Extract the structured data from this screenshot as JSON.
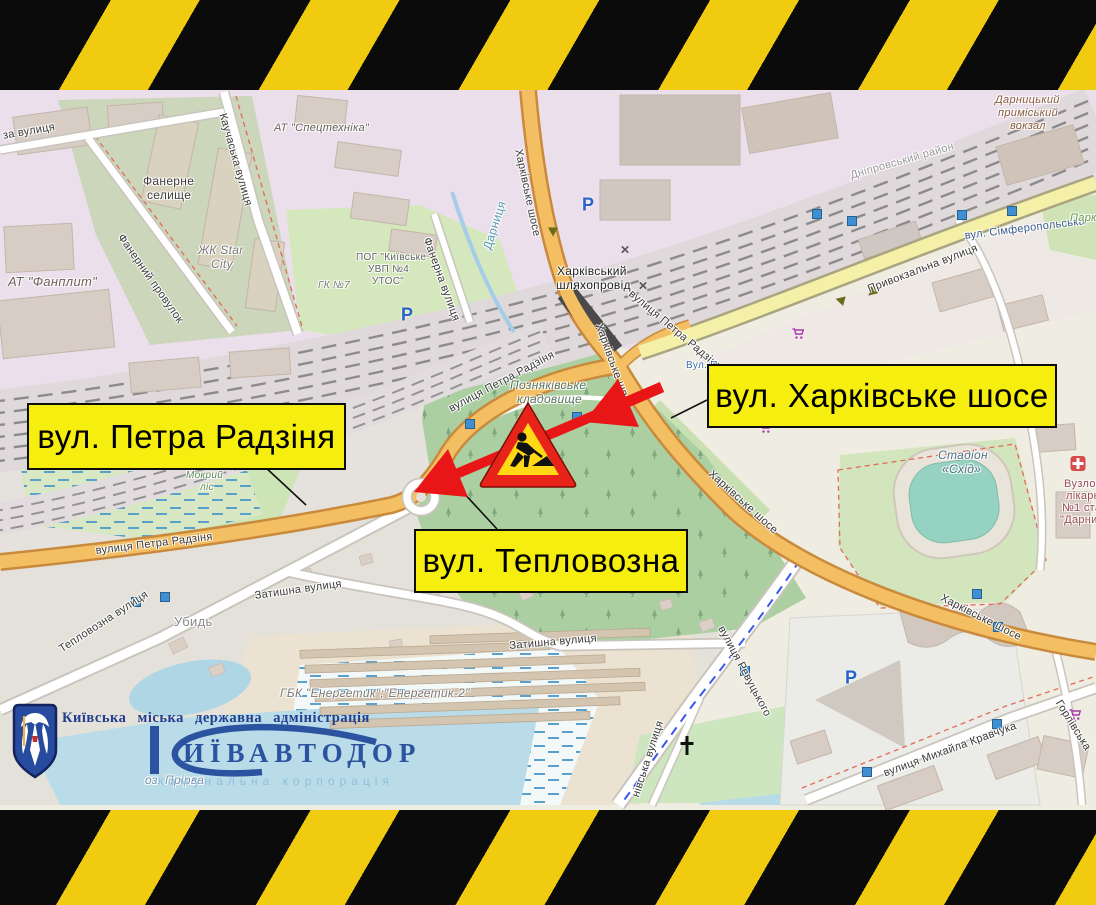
{
  "annotations": {
    "boxes": [
      {
        "name": "label-petra-radzinya",
        "text": "вул. Петра Радзіня",
        "x": 27,
        "y": 403,
        "w": 315,
        "h": 63
      },
      {
        "name": "label-kharkivske-shose",
        "text": "вул. Харківське шосе",
        "x": 707,
        "y": 364,
        "w": 346,
        "h": 60
      },
      {
        "name": "label-teplovozna",
        "text": "вул. Тепловозна",
        "x": 414,
        "y": 529,
        "w": 270,
        "h": 60
      }
    ]
  },
  "map": {
    "parking_glyph": "P",
    "labels": [
      {
        "t": "за вулиця",
        "x": 2,
        "y": 130,
        "r": -10
      },
      {
        "t": "Каучаська вулиця",
        "x": 228,
        "y": 112,
        "r": 74
      },
      {
        "t": "АТ \"Спецтехніка\"",
        "x": 274,
        "y": 122,
        "c": "#6b6158",
        "i": 1
      },
      {
        "t": "Фанерне",
        "x": 143,
        "y": 174,
        "c": "#3d3d3d",
        "s": 12
      },
      {
        "t": "селище",
        "x": 147,
        "y": 188,
        "c": "#3d3d3d",
        "s": 12
      },
      {
        "t": "ЖК Star",
        "x": 198,
        "y": 243,
        "c": "#7a7a7a",
        "i": 1,
        "s": 12
      },
      {
        "t": "City",
        "x": 211,
        "y": 257,
        "c": "#7a7a7a",
        "i": 1,
        "s": 12
      },
      {
        "t": "АТ \"Фанплит\"",
        "x": 8,
        "y": 274,
        "c": "#6b6158",
        "i": 1,
        "s": 13
      },
      {
        "t": "Фанерний провулок",
        "x": 125,
        "y": 232,
        "r": 55
      },
      {
        "t": "ПОГ \"Київське",
        "x": 356,
        "y": 252,
        "c": "#666",
        "s": 10
      },
      {
        "t": "УВП №4",
        "x": 368,
        "y": 264,
        "c": "#666",
        "s": 10
      },
      {
        "t": "УТОС\"",
        "x": 372,
        "y": 276,
        "c": "#666",
        "s": 10
      },
      {
        "t": "ГК №7",
        "x": 318,
        "y": 280,
        "c": "#7a7a7a",
        "i": 1,
        "s": 10
      },
      {
        "t": "Фанерна вулиця",
        "x": 432,
        "y": 236,
        "r": 70
      },
      {
        "t": "Дарниця",
        "x": 480,
        "y": 247,
        "r": -72,
        "c": "#5a99b5",
        "s": 12
      },
      {
        "t": "Харківське шосе",
        "x": 524,
        "y": 148,
        "r": 78
      },
      {
        "t": "Харківський",
        "x": 557,
        "y": 264,
        "c": "#222",
        "s": 12
      },
      {
        "t": "шляхопровід",
        "x": 556,
        "y": 278,
        "c": "#222",
        "s": 12
      },
      {
        "t": "вулиця Петра Радзіня",
        "x": 634,
        "y": 288,
        "r": 40
      },
      {
        "t": "Вул. П",
        "x": 686,
        "y": 360,
        "c": "#3e6fb0",
        "s": 10
      },
      {
        "t": "Харківське шосе",
        "x": 604,
        "y": 322,
        "r": 70
      },
      {
        "t": "Привокзальна вулиця",
        "x": 866,
        "y": 284,
        "r": -21
      },
      {
        "t": "вул. Сімферопольська",
        "x": 964,
        "y": 230,
        "r": -7,
        "c": "#3b5b8c"
      },
      {
        "t": "Дарницький",
        "x": 995,
        "y": 94,
        "c": "#8a5a3c",
        "i": 1
      },
      {
        "t": "приміський",
        "x": 998,
        "y": 107,
        "c": "#8a5a3c",
        "i": 1
      },
      {
        "t": "вокзал",
        "x": 1010,
        "y": 120,
        "c": "#8a5a3c",
        "i": 1
      },
      {
        "t": "Дніпровський район",
        "x": 849,
        "y": 170,
        "r": -16,
        "c": "#9a9a9a"
      },
      {
        "t": "Парк",
        "x": 1070,
        "y": 212,
        "c": "#5f9c4e",
        "i": 1
      },
      {
        "t": "Позняківське",
        "x": 510,
        "y": 378,
        "c": "#5a7560",
        "i": 1,
        "s": 12
      },
      {
        "t": "кладовище",
        "x": 517,
        "y": 392,
        "c": "#5a7560",
        "i": 1,
        "s": 12
      },
      {
        "t": "Мокрий",
        "x": 186,
        "y": 470,
        "c": "#5e8c52",
        "i": 1,
        "s": 10
      },
      {
        "t": "ліс",
        "x": 200,
        "y": 482,
        "c": "#5e8c52",
        "i": 1,
        "s": 10
      },
      {
        "t": "вулиця Петра Радзіня",
        "x": 95,
        "y": 545,
        "r": -7
      },
      {
        "t": "вулиця Петра Радзіня",
        "x": 447,
        "y": 404,
        "r": -28
      },
      {
        "t": "Тепловозна вулиця",
        "x": 57,
        "y": 645,
        "r": -33
      },
      {
        "t": "Затишна вулиця",
        "x": 254,
        "y": 590,
        "r": -8
      },
      {
        "t": "Убидь",
        "x": 174,
        "y": 614,
        "c": "#8a8a8a",
        "s": 13
      },
      {
        "t": "Затишна вулиця",
        "x": 509,
        "y": 640,
        "r": -5
      },
      {
        "t": "ГБК \"Енергетик\";\"Енергетик-2\"",
        "x": 280,
        "y": 686,
        "c": "#7a7a7a",
        "i": 1,
        "s": 12
      },
      {
        "t": "Харківське шосе",
        "x": 714,
        "y": 468,
        "r": 42
      },
      {
        "t": "Харківське шосе",
        "x": 944,
        "y": 592,
        "r": 27
      },
      {
        "t": "вулиця Ревуцького",
        "x": 726,
        "y": 624,
        "r": 62
      },
      {
        "t": "нівська вулиця",
        "x": 630,
        "y": 795,
        "r": -72
      },
      {
        "t": "вулиця Михайла Кравчука",
        "x": 882,
        "y": 768,
        "r": -20
      },
      {
        "t": "Горлівська",
        "x": 1063,
        "y": 698,
        "r": 58
      },
      {
        "t": "Стадіон",
        "x": 938,
        "y": 448,
        "c": "#4c7080",
        "i": 1,
        "s": 12
      },
      {
        "t": "«Схід»",
        "x": 942,
        "y": 462,
        "c": "#4c7080",
        "i": 1,
        "s": 12
      },
      {
        "t": "Вузлов",
        "x": 1064,
        "y": 478,
        "c": "#994a52"
      },
      {
        "t": "лікарн",
        "x": 1066,
        "y": 490,
        "c": "#994a52"
      },
      {
        "t": "№1 стан",
        "x": 1062,
        "y": 502,
        "c": "#994a52"
      },
      {
        "t": "\"Дарниц",
        "x": 1060,
        "y": 514,
        "c": "#994a52"
      },
      {
        "t": "оз. Прірва",
        "x": 145,
        "y": 773,
        "c": "#7d93a8",
        "i": 1,
        "s": 12
      }
    ],
    "markers": [
      {
        "k": "p",
        "x": 588,
        "y": 205
      },
      {
        "k": "p",
        "x": 407,
        "y": 315
      },
      {
        "k": "p",
        "x": 851,
        "y": 678
      },
      {
        "k": "stop",
        "x": 470,
        "y": 424
      },
      {
        "k": "stop",
        "x": 577,
        "y": 417
      },
      {
        "k": "stop",
        "x": 136,
        "y": 602
      },
      {
        "k": "stop",
        "x": 165,
        "y": 597
      },
      {
        "k": "stop",
        "x": 817,
        "y": 214
      },
      {
        "k": "stop",
        "x": 852,
        "y": 221
      },
      {
        "k": "stop",
        "x": 962,
        "y": 215
      },
      {
        "k": "stop",
        "x": 1012,
        "y": 211
      },
      {
        "k": "stop",
        "x": 745,
        "y": 671
      },
      {
        "k": "stop",
        "x": 977,
        "y": 594
      },
      {
        "k": "stop",
        "x": 998,
        "y": 627
      },
      {
        "k": "stop",
        "x": 997,
        "y": 724
      },
      {
        "k": "stop",
        "x": 867,
        "y": 772
      },
      {
        "k": "cart",
        "x": 798,
        "y": 336
      },
      {
        "k": "cart",
        "x": 765,
        "y": 430
      },
      {
        "k": "cart",
        "x": 1075,
        "y": 717
      },
      {
        "k": "x",
        "x": 625,
        "y": 250
      },
      {
        "k": "x",
        "x": 643,
        "y": 286
      },
      {
        "k": "hosp",
        "x": 1078,
        "y": 466
      },
      {
        "k": "church",
        "x": 687,
        "y": 748
      },
      {
        "k": "ow",
        "x": 553,
        "y": 232,
        "r": 90
      },
      {
        "k": "ow",
        "x": 840,
        "y": 300,
        "r": 195
      },
      {
        "k": "ow",
        "x": 874,
        "y": 292,
        "r": 15
      }
    ]
  },
  "logo": {
    "admin_text": "Київська міська державна адміністрація",
    "brand_text": "ИЇВАВТОДОР",
    "sub_text": "комунальна корпорація"
  }
}
